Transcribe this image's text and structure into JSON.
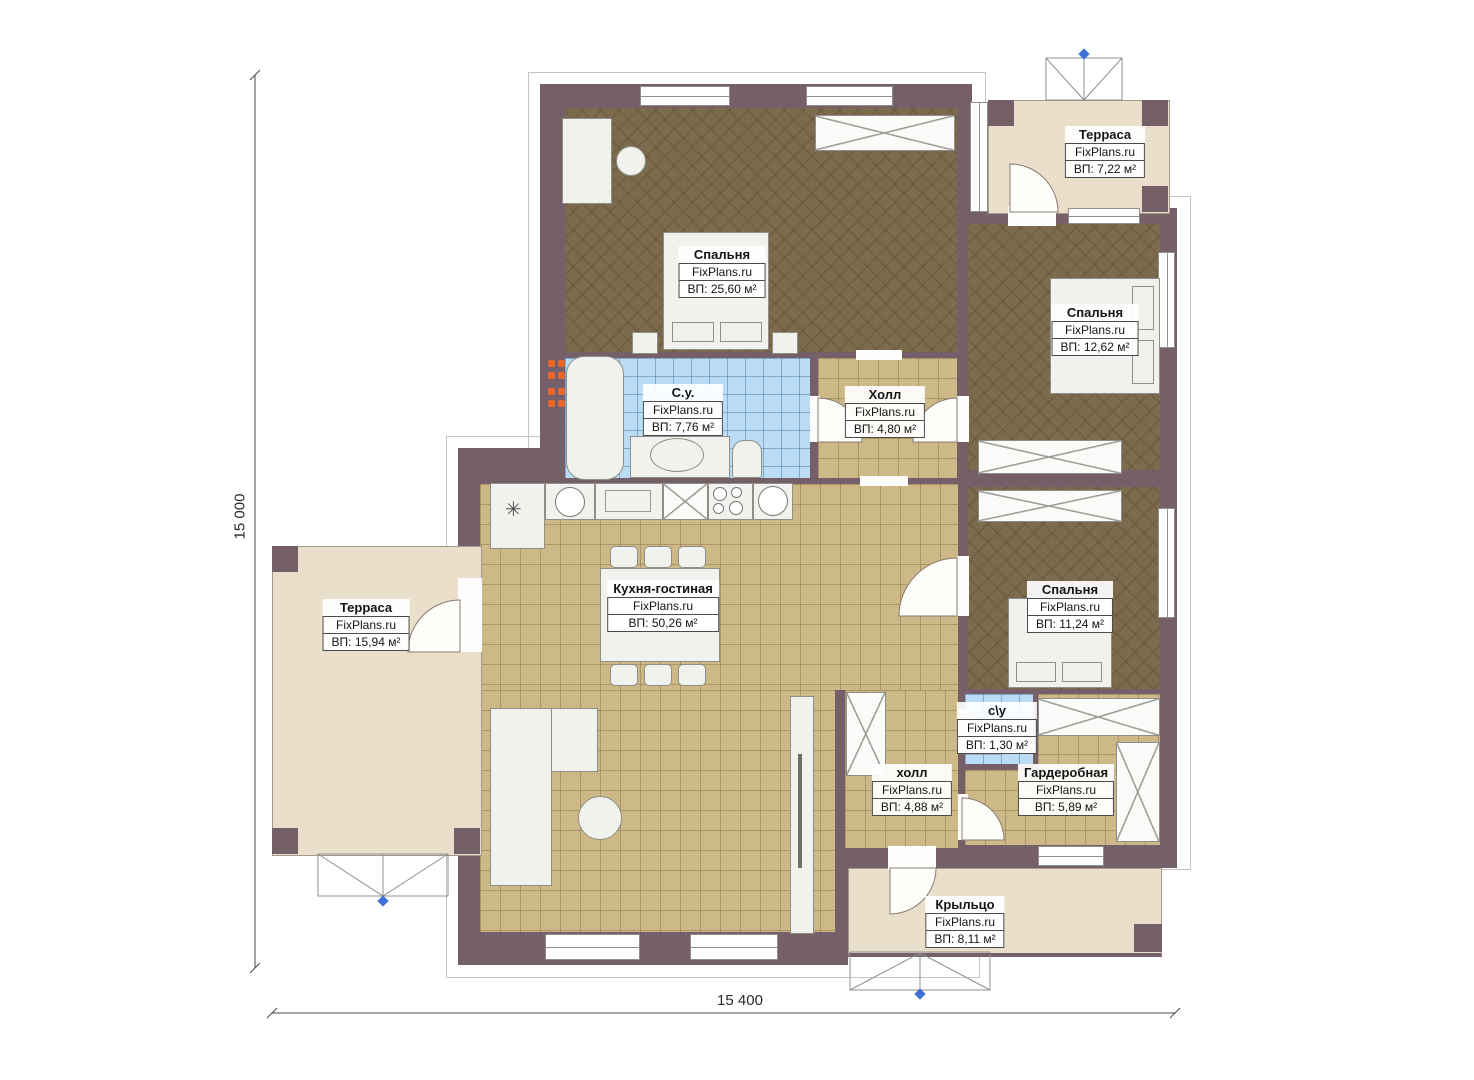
{
  "plan": {
    "brand": "FixPlans.ru",
    "dimensions": {
      "height_label": "15 000",
      "width_label": "15 400"
    },
    "rooms": {
      "bedroom_top_left": {
        "name": "Спальня",
        "brand": "FixPlans.ru",
        "area": "ВП: 25,60 м²"
      },
      "terrace_top": {
        "name": "Терраса",
        "brand": "FixPlans.ru",
        "area": "ВП: 7,22 м²"
      },
      "bedroom_top_right": {
        "name": "Спальня",
        "brand": "FixPlans.ru",
        "area": "ВП: 12,62 м²"
      },
      "bathroom_main": {
        "name": "С.у.",
        "brand": "FixPlans.ru",
        "area": "ВП: 7,76 м²"
      },
      "hall_top": {
        "name": "Холл",
        "brand": "FixPlans.ru",
        "area": "ВП: 4,80 м²"
      },
      "kitchen_living": {
        "name": "Кухня-гостиная",
        "brand": "FixPlans.ru",
        "area": "ВП: 50,26 м²"
      },
      "terrace_left": {
        "name": "Терраса",
        "brand": "FixPlans.ru",
        "area": "ВП: 15,94 м²"
      },
      "bedroom_right": {
        "name": "Спальня",
        "brand": "FixPlans.ru",
        "area": "ВП: 11,24 м²"
      },
      "bathroom_small": {
        "name": "с\\у",
        "brand": "FixPlans.ru",
        "area": "ВП: 1,30 м²"
      },
      "hall_small": {
        "name": "холл",
        "brand": "FixPlans.ru",
        "area": "ВП: 4,88 м²"
      },
      "wardrobe_room": {
        "name": "Гардеробная",
        "brand": "FixPlans.ru",
        "area": "ВП: 5,89 м²"
      },
      "porch": {
        "name": "Крыльцо",
        "brand": "FixPlans.ru",
        "area": "ВП: 8,11 м²"
      }
    },
    "colors": {
      "wall": "#756069",
      "wood_floor": "#7d6b4d",
      "tile_floor": "#cdb887",
      "bath_floor": "#badcf5",
      "terrace": "#e9dfcb",
      "stairs_marker": "#3f6fd8",
      "radiator": "#e8672a"
    }
  }
}
